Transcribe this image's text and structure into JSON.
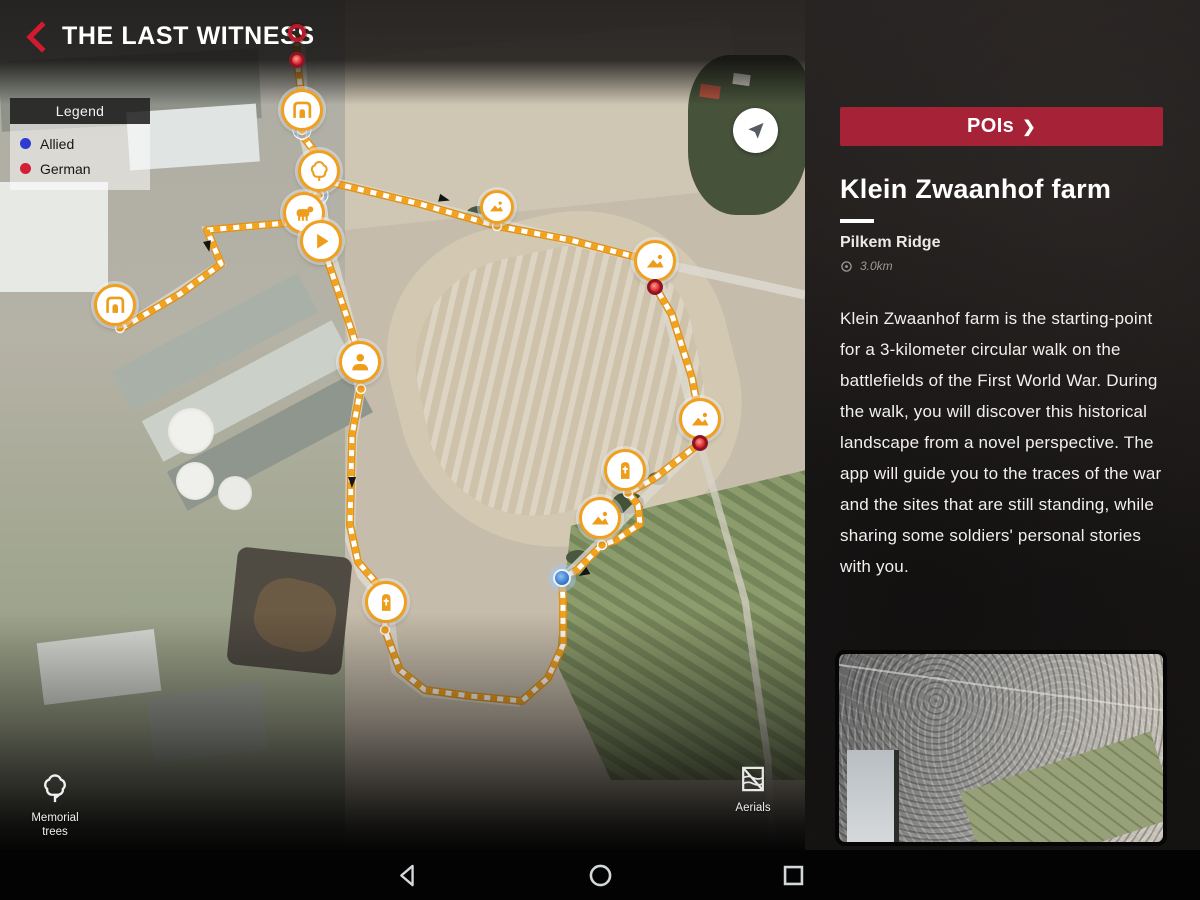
{
  "app": {
    "title": "THE LAST WITNESS",
    "to_start_label": "To start"
  },
  "icons": {
    "pois_chevron": "❯"
  },
  "colors": {
    "accent_red": "#a52237",
    "route_orange": "#f2a21d",
    "allied_blue": "#2d3bd1",
    "german_red": "#d41f36"
  },
  "legend": {
    "title": "Legend",
    "items": [
      {
        "label": "Allied",
        "color": "#2d3bd1"
      },
      {
        "label": "German",
        "color": "#d41f36"
      }
    ]
  },
  "map_buttons": {
    "memorial_trees_label": "Memorial trees",
    "aerials_label": "Aerials"
  },
  "poi_panel": {
    "pois_button_label": "POIs",
    "title": "Klein Zwaanhof farm",
    "subtitle": "Pilkem Ridge",
    "distance": "3.0km",
    "description": "Klein Zwaanhof farm is the starting-point for a 3-kilometer circular walk on the battlefields of the First World War. During the walk, you will discover this historical landscape from a novel perspective. The app will guide you to the traces of the war and the sites that are still standing, while sharing some soldiers' personal stories with you."
  },
  "map": {
    "route": [
      [
        [
          297,
          33
        ],
        [
          297,
          60
        ],
        [
          301,
          92
        ],
        [
          302,
          135
        ],
        [
          315,
          152
        ],
        [
          319,
          195
        ],
        [
          308,
          210
        ],
        [
          312,
          228
        ],
        [
          321,
          241
        ],
        [
          336,
          285
        ],
        [
          352,
          332
        ],
        [
          361,
          362
        ],
        [
          360,
          392
        ],
        [
          352,
          435
        ],
        [
          350,
          525
        ],
        [
          358,
          562
        ],
        [
          384,
          592
        ],
        [
          385,
          630
        ],
        [
          394,
          655
        ],
        [
          400,
          670
        ],
        [
          425,
          690
        ],
        [
          470,
          696
        ],
        [
          522,
          701
        ],
        [
          548,
          678
        ],
        [
          563,
          645
        ],
        [
          563,
          600
        ],
        [
          562,
          578
        ],
        [
          577,
          570
        ],
        [
          602,
          545
        ],
        [
          616,
          540
        ],
        [
          640,
          524
        ],
        [
          638,
          505
        ],
        [
          628,
          493
        ],
        [
          655,
          478
        ],
        [
          700,
          443
        ],
        [
          700,
          420
        ],
        [
          692,
          378
        ],
        [
          672,
          315
        ],
        [
          656,
          288
        ],
        [
          655,
          262
        ],
        [
          570,
          240
        ],
        [
          497,
          226
        ],
        [
          420,
          204
        ],
        [
          325,
          181
        ]
      ],
      [
        [
          298,
          222
        ],
        [
          252,
          226
        ],
        [
          207,
          230
        ],
        [
          221,
          264
        ],
        [
          180,
          294
        ],
        [
          122,
          328
        ]
      ]
    ],
    "anchor_dots": [
      {
        "x": 302,
        "y": 135
      },
      {
        "x": 319,
        "y": 195,
        "halo": true
      },
      {
        "x": 302,
        "y": 130,
        "halo": true
      },
      {
        "x": 120,
        "y": 328
      },
      {
        "x": 361,
        "y": 389
      },
      {
        "x": 385,
        "y": 630
      },
      {
        "x": 497,
        "y": 226
      },
      {
        "x": 628,
        "y": 493
      },
      {
        "x": 602,
        "y": 545
      }
    ],
    "arrows": [
      {
        "x": 444,
        "y": 199,
        "r": 14
      },
      {
        "x": 584,
        "y": 573,
        "r": 150
      },
      {
        "x": 352,
        "y": 482,
        "r": 91
      },
      {
        "x": 208,
        "y": 246,
        "r": 78
      }
    ],
    "markers": [
      {
        "x": 297,
        "y": 33,
        "type": "red-ring"
      },
      {
        "x": 297,
        "y": 60,
        "type": "red-dot"
      },
      {
        "x": 302,
        "y": 110,
        "type": "arch"
      },
      {
        "x": 319,
        "y": 171,
        "type": "tree"
      },
      {
        "x": 304,
        "y": 213,
        "type": "cattle"
      },
      {
        "x": 321,
        "y": 241,
        "type": "play"
      },
      {
        "x": 115,
        "y": 305,
        "type": "arch"
      },
      {
        "x": 360,
        "y": 362,
        "type": "person"
      },
      {
        "x": 386,
        "y": 602,
        "type": "grave"
      },
      {
        "x": 497,
        "y": 207,
        "type": "photo",
        "small": true
      },
      {
        "x": 655,
        "y": 261,
        "type": "photo"
      },
      {
        "x": 655,
        "y": 287,
        "type": "red-dot"
      },
      {
        "x": 700,
        "y": 419,
        "type": "photo"
      },
      {
        "x": 700,
        "y": 443,
        "type": "red-dot"
      },
      {
        "x": 625,
        "y": 470,
        "type": "grave"
      },
      {
        "x": 600,
        "y": 518,
        "type": "photo"
      },
      {
        "x": 562,
        "y": 578,
        "type": "blue-dot"
      }
    ]
  },
  "android_nav": {
    "back": "back",
    "home": "home",
    "recents": "recents"
  }
}
